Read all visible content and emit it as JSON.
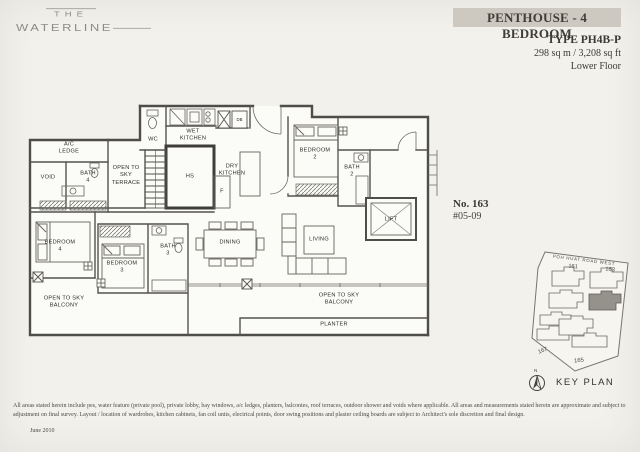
{
  "logo": {
    "line1": "THE",
    "line2": "WATERLINE"
  },
  "header": {
    "title": "PENTHOUSE - 4 BEDROOM",
    "type_label": "TYPE PH4B-P",
    "area": "298 sq m / 3,208 sq ft",
    "floor": "Lower Floor"
  },
  "unit": {
    "number": "No. 163",
    "stack": "#05-09"
  },
  "floorplan": {
    "labels": {
      "ac_ledge": "A/C\nLEDGE",
      "void": "VOID",
      "bath4": "BATH\n4",
      "terrace": "OPEN TO\nSKY\nTERRACE",
      "wc": "WC",
      "wet_kitchen": "WET\nKITCHEN",
      "db": "DB",
      "hs": "HS",
      "f": "F",
      "dry_kitchen": "DRY\nKITCHEN",
      "bedroom2": "BEDROOM\n2",
      "bath2": "BATH\n2",
      "lift": "LIFT",
      "bedroom4": "BEDROOM\n4",
      "bedroom3": "BEDROOM\n3",
      "bath3": "BATH\n3",
      "dining": "DINING",
      "living": "LIVING",
      "balcony_left": "OPEN TO SKY\nBALCONY",
      "balcony_right": "OPEN TO SKY\nBALCONY",
      "planter": "PLANTER"
    }
  },
  "keyplan": {
    "road": "POH HUAT ROAD WEST",
    "b161": "161",
    "b163": "163",
    "b167": "167",
    "b165": "165",
    "compass_n": "N",
    "label": "KEY PLAN"
  },
  "footer": {
    "line1": "All areas stated herein include pes, water feature (private pool), private lobby, bay windows, a/c ledges, planters, balconies, roof terraces, outdoor shower and voids where applicable. All areas and measurements stated herein are approximate and subject to",
    "line2": "adjustment on final survey. Layout / location of wardrobes, kitchen cabinets, fan coil units, electrical points, door swing positions and plaster ceiling boards are subject to Architect's sole discretion and final design.",
    "date": "June 2010"
  },
  "colors": {
    "accent_bar": "#cdc9c1",
    "wall": "#4f4d49",
    "paper": "#f2f1ec",
    "highlight_unit": "#95928b"
  }
}
